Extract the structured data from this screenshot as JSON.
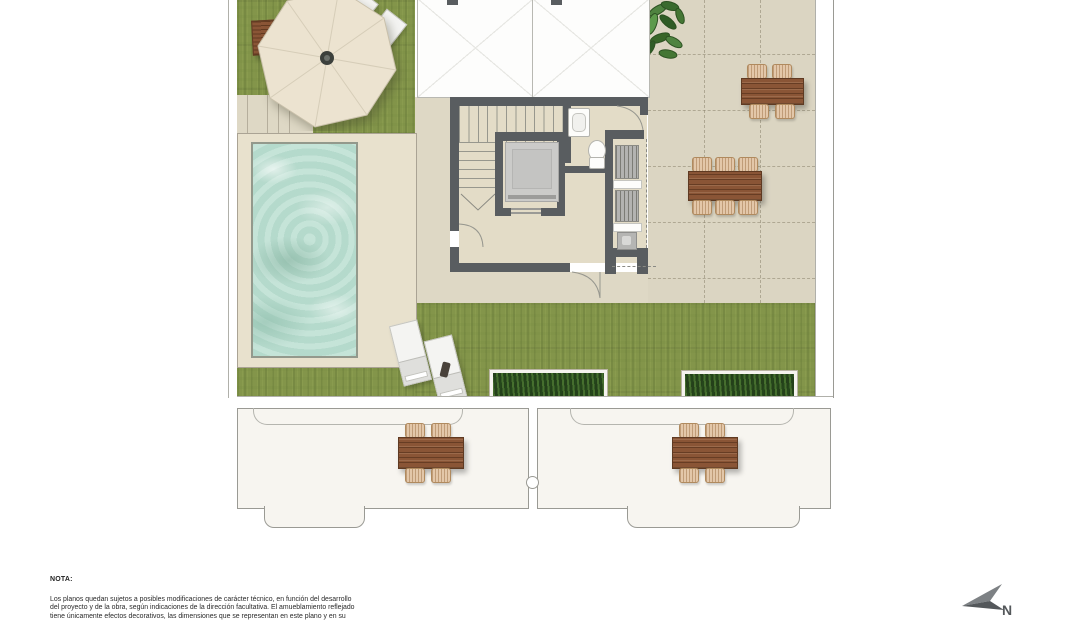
{
  "note": {
    "label": "NOTA:",
    "lines": [
      "Los planos quedan sujetos a posibles modificaciones de carácter técnico, en función del desarrollo",
      "del proyecto y de la obra, según indicaciones de la dirección facultativa. El amueblamiento reflejado",
      "tiene únicamente efectos decorativos, las dimensiones que se representan en este plano y en su"
    ]
  },
  "compass": {
    "label": "N"
  },
  "palette": {
    "background": "#ffffff",
    "grass": "#83954a",
    "tile_terrace": "#dbd5c2",
    "pool_deck": "#e8e1cd",
    "pool_water": "#bcdfd2",
    "wall": "#595d60",
    "wood": "#8a5536",
    "wicker": "#e3c7a9",
    "planter_green": "#24401a",
    "umbrella": "#ece3d0",
    "lower_terrace": "#f7f5f0"
  }
}
